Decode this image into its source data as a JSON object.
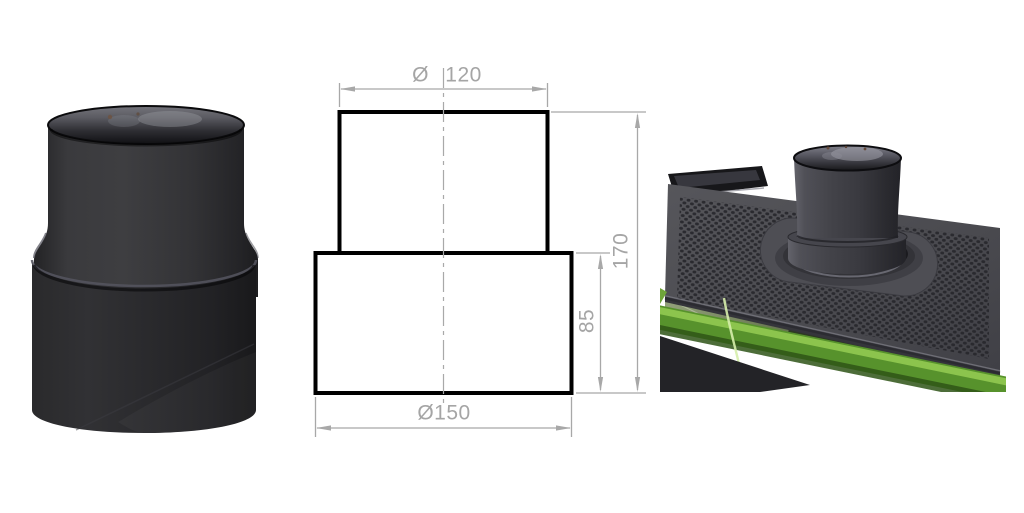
{
  "drawing": {
    "labels": {
      "top_diameter": "Ø 120",
      "total_height": "170",
      "base_height": "85",
      "base_diameter": "Ø150"
    },
    "colors": {
      "dimension_gray": "#a5a5a5",
      "outline_black": "#000000",
      "background": "#ffffff"
    }
  },
  "photos": {
    "colors": {
      "pipe_dark": "#2e2e31",
      "stove_plate_gray": "#4f4f54",
      "stove_body_green": "#5d9630"
    }
  }
}
